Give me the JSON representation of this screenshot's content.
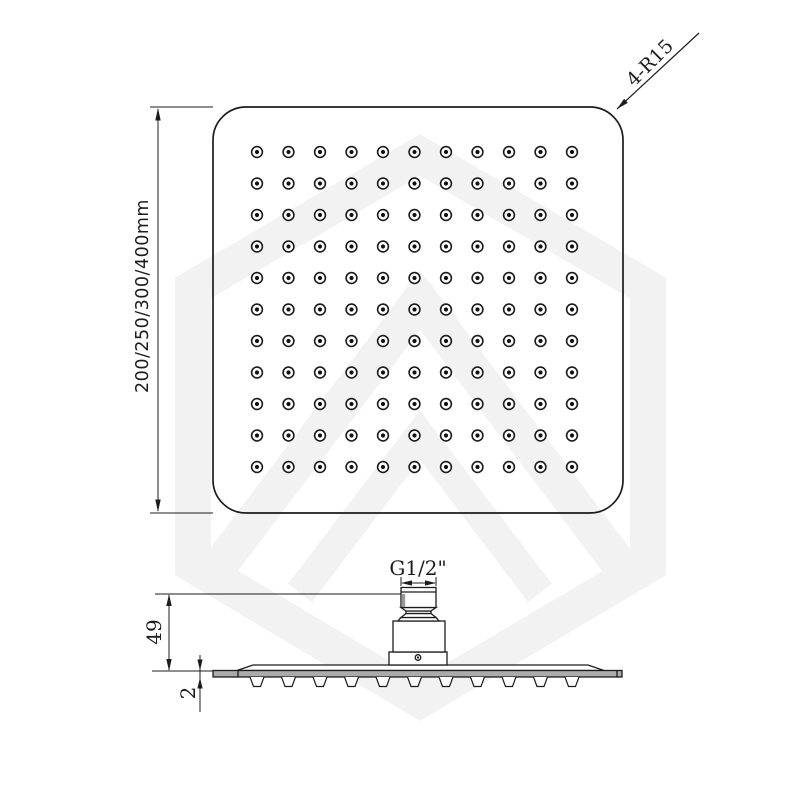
{
  "drawing": {
    "top_view": {
      "width_dim": "200/250/300/400mm",
      "corner_radius_label": "4-R15",
      "nozzle_grid": {
        "rows": 11,
        "cols": 11
      }
    },
    "side_view": {
      "thread_label": "G1/2\"",
      "height_dim": "49",
      "thickness_dim": "2"
    }
  },
  "colors": {
    "line": "#1c1c1c",
    "plate_fill": "#ababab",
    "thread_shade": "#9a9a9a",
    "watermark": "#f2f2f2",
    "background": "#ffffff"
  }
}
